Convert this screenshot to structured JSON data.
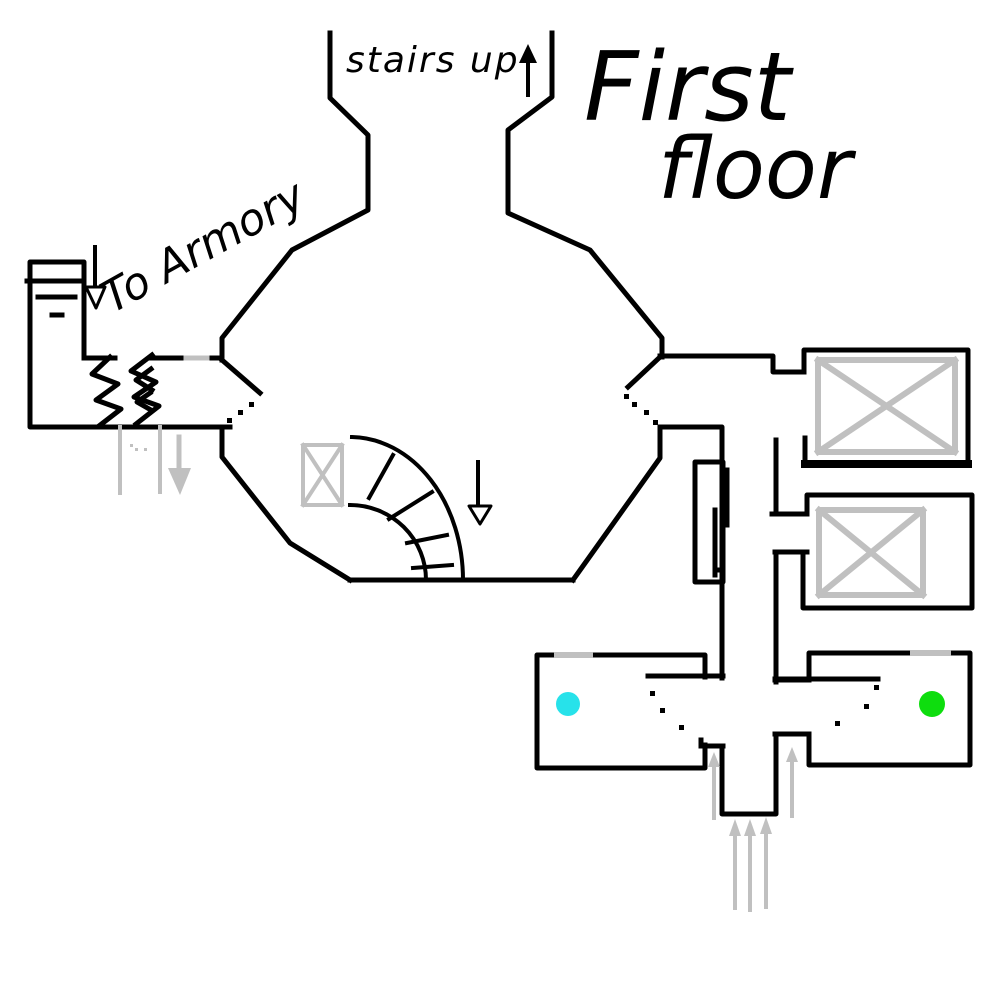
{
  "page": {
    "background": "#ffffff"
  },
  "labels": {
    "stairs_up": "stairs up",
    "title_line1": "First",
    "title_line2": "floor",
    "to_armory": "To Armory"
  },
  "colors": {
    "ink": "#000000",
    "pencil_gray": "#c0c0c0",
    "cyan_marker": "#27e2ea",
    "green_marker": "#0edd0e"
  },
  "icons": {
    "stairs_up_arrow": "↑",
    "hall_down_arrow": "↓",
    "armory_down_arrow": "↓",
    "entrance_arrows": "↑↑↑↑↑",
    "gray_down_arrow": "↓",
    "crate_box": "⊠"
  }
}
